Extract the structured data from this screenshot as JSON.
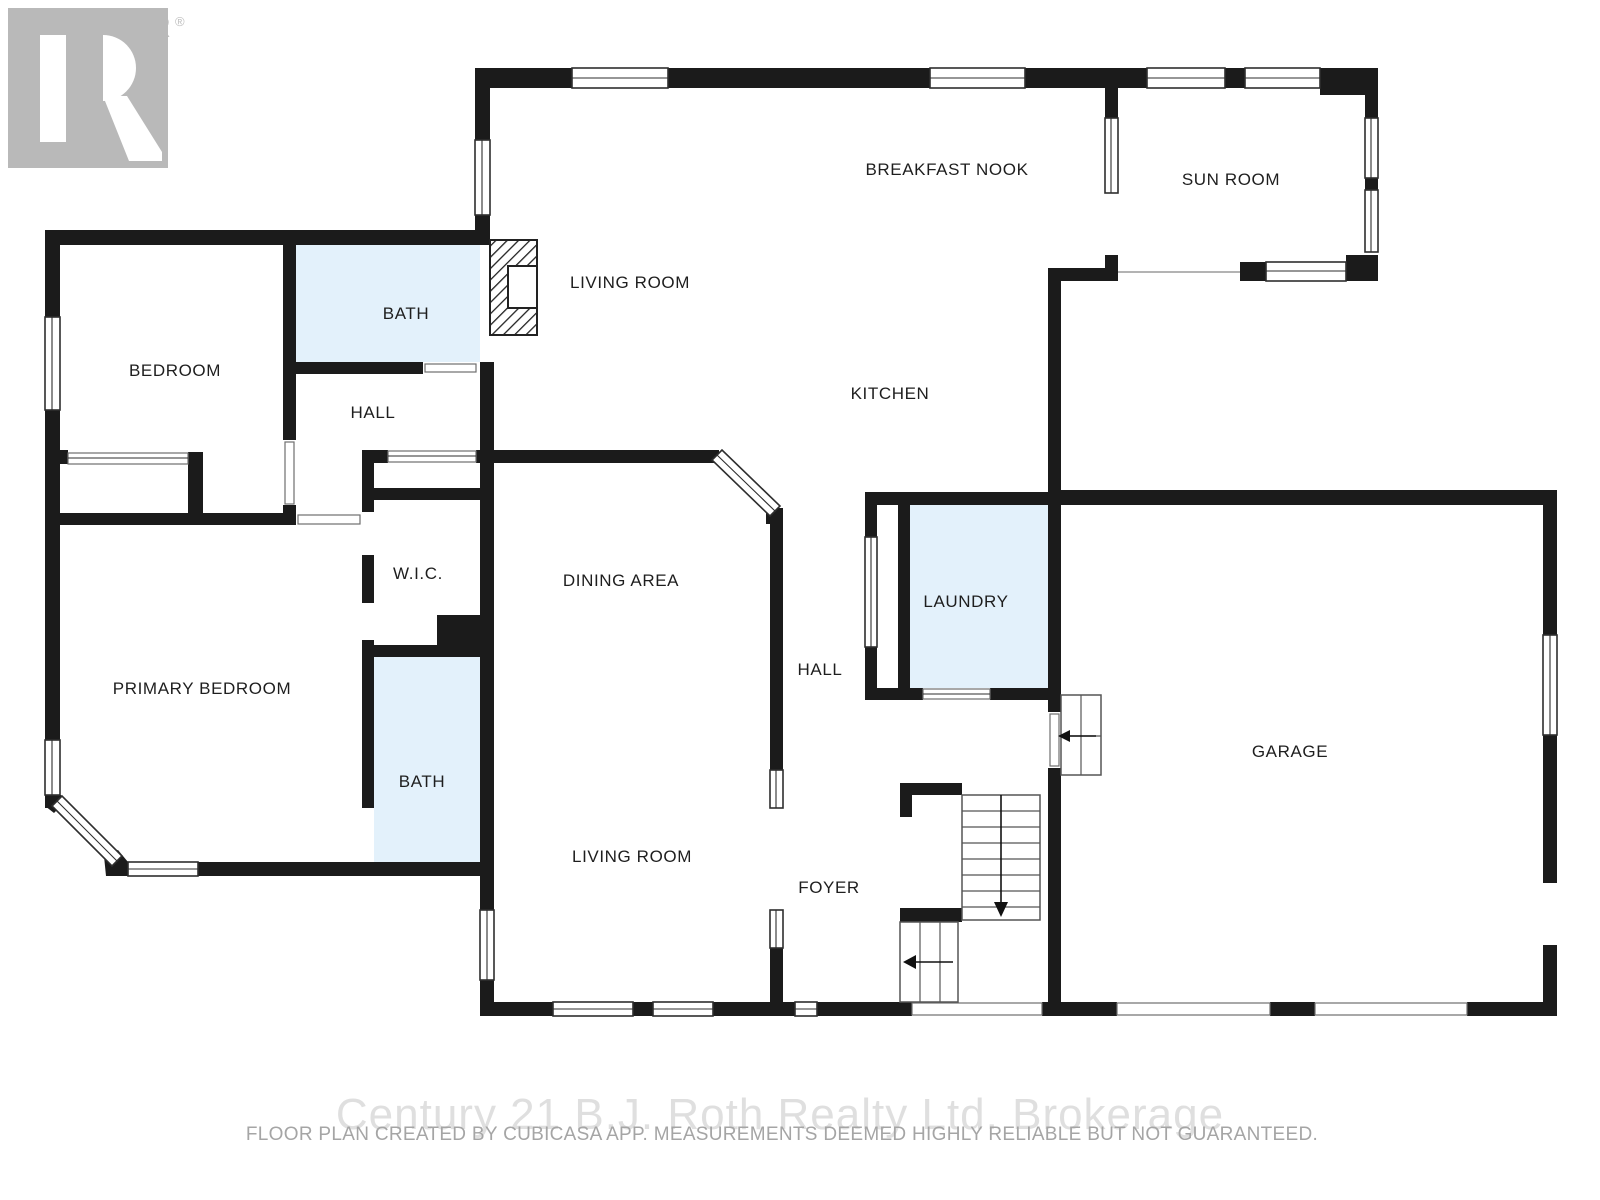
{
  "logo": {
    "text": "REALTOR",
    "registered_mark": "®"
  },
  "rooms": {
    "breakfast_nook": "BREAKFAST NOOK",
    "sun_room": "SUN ROOM",
    "living_room_upper": "LIVING ROOM",
    "bath_upper": "BATH",
    "bedroom": "BEDROOM",
    "hall_upper": "HALL",
    "kitchen": "KITCHEN",
    "wic": "W.I.C.",
    "dining_area": "DINING AREA",
    "laundry": "LAUNDRY",
    "hall_lower": "HALL",
    "primary_bedroom": "PRIMARY BEDROOM",
    "bath_lower": "BATH",
    "garage": "GARAGE",
    "living_room_lower": "LIVING ROOM",
    "foyer": "FOYER"
  },
  "footer": {
    "watermark": "Century 21 B.J. Roth Realty Ltd. Brokerage",
    "disclaimer": "FLOOR PLAN CREATED BY CUBICASA APP. MEASUREMENTS DEEMED HIGHLY RELIABLE BUT NOT GUARANTEED."
  },
  "colors": {
    "wall": "#1b1b1b",
    "wet_room_fill": "#e3f1fb",
    "logo_gray": "#b9b9b9",
    "watermark_gray": "#c5c5c5",
    "disclaimer_gray": "#a5a5a5"
  }
}
